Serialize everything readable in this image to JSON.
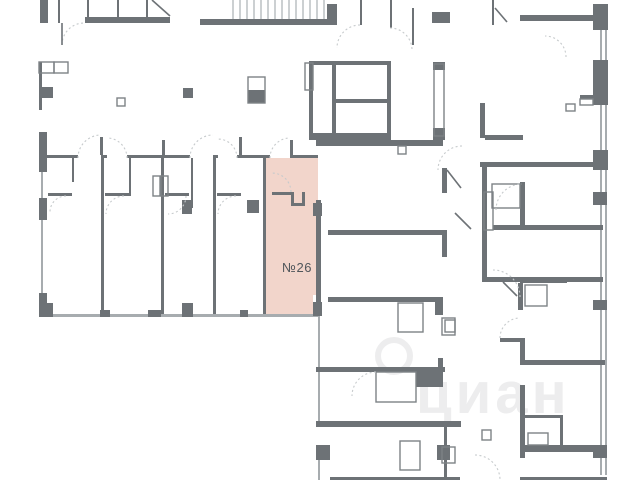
{
  "palette": {
    "background": "#ffffff",
    "wall": "#6d7276",
    "outline": "#7d8286",
    "window": "#a7acaf",
    "arc": "#c6cacc",
    "stair": "#9aa0a4",
    "highlight_fill": "#f2d5cb",
    "label_color": "#50565b",
    "watermark_color": "#ededee"
  },
  "unit": {
    "label": "№26",
    "x": 266,
    "y": 158,
    "w": 52,
    "h": 156,
    "label_x": 297,
    "label_y": 272,
    "notch": [
      313,
      295,
      8,
      20
    ]
  },
  "watermark": {
    "text": "циан",
    "x": 416,
    "y": 413,
    "size": 58,
    "circle": {
      "cx": 394,
      "cy": 356,
      "r": 16
    }
  },
  "stairs": {
    "x": 233,
    "y": 0,
    "w": 94,
    "h": 20,
    "step": 7
  },
  "geometry": {
    "walls": [
      [
        40,
        0,
        8,
        23
      ],
      [
        85,
        17,
        85,
        6
      ],
      [
        200,
        19,
        137,
        6
      ],
      [
        327,
        4,
        10,
        21
      ],
      [
        432,
        12,
        18,
        11
      ],
      [
        520,
        15,
        74,
        6
      ],
      [
        593,
        4,
        15,
        26
      ],
      [
        39,
        132,
        8,
        40
      ],
      [
        39,
        198,
        8,
        22
      ],
      [
        39,
        293,
        8,
        24
      ],
      [
        40,
        303,
        13,
        14
      ],
      [
        42,
        87,
        11,
        11
      ],
      [
        183,
        88,
        10,
        10
      ],
      [
        248,
        90,
        17,
        13
      ],
      [
        309,
        61,
        4,
        79
      ],
      [
        387,
        61,
        4,
        79
      ],
      [
        309,
        61,
        82,
        4
      ],
      [
        309,
        133,
        82,
        7
      ],
      [
        332,
        63,
        4,
        70
      ],
      [
        336,
        99,
        51,
        4
      ],
      [
        433,
        62,
        12,
        8
      ],
      [
        433,
        128,
        12,
        12
      ],
      [
        316,
        140,
        127,
        6
      ],
      [
        328,
        230,
        115,
        5
      ],
      [
        328,
        297,
        115,
        5
      ],
      [
        442,
        168,
        5,
        25
      ],
      [
        442,
        230,
        5,
        27
      ],
      [
        435,
        297,
        8,
        18
      ],
      [
        480,
        103,
        5,
        35
      ],
      [
        485,
        135,
        38,
        5
      ],
      [
        480,
        162,
        121,
        5
      ],
      [
        482,
        167,
        5,
        65
      ],
      [
        520,
        182,
        5,
        45
      ],
      [
        493,
        225,
        110,
        5
      ],
      [
        482,
        230,
        5,
        52
      ],
      [
        483,
        277,
        120,
        5
      ],
      [
        520,
        280,
        47,
        3
      ],
      [
        518,
        283,
        5,
        27
      ],
      [
        593,
        300,
        14,
        10
      ],
      [
        580,
        95,
        15,
        4
      ],
      [
        500,
        338,
        22,
        4
      ],
      [
        520,
        338,
        5,
        27
      ],
      [
        522,
        360,
        83,
        5
      ],
      [
        316,
        367,
        129,
        5
      ],
      [
        316,
        421,
        145,
        6
      ],
      [
        416,
        372,
        24,
        15
      ],
      [
        438,
        358,
        5,
        29
      ],
      [
        316,
        445,
        14,
        15
      ],
      [
        437,
        445,
        13,
        15
      ],
      [
        520,
        385,
        5,
        73
      ],
      [
        522,
        445,
        85,
        7
      ],
      [
        593,
        445,
        14,
        13
      ],
      [
        593,
        60,
        15,
        45
      ],
      [
        593,
        150,
        15,
        20
      ],
      [
        593,
        192,
        14,
        13
      ],
      [
        525,
        415,
        38,
        3
      ],
      [
        560,
        418,
        3,
        27
      ],
      [
        182,
        200,
        10,
        14
      ],
      [
        247,
        200,
        12,
        13
      ],
      [
        313,
        203,
        9,
        13
      ],
      [
        313,
        302,
        9,
        14
      ],
      [
        316,
        200,
        5,
        103
      ],
      [
        100,
        310,
        10,
        7
      ],
      [
        148,
        310,
        13,
        7
      ],
      [
        182,
        303,
        11,
        14
      ],
      [
        240,
        310,
        8,
        7
      ],
      [
        330,
        477,
        130,
        3
      ],
      [
        520,
        477,
        87,
        3
      ]
    ],
    "thin_walls": [
      [
        58,
        0,
        2,
        23
      ],
      [
        87,
        0,
        2,
        17
      ],
      [
        117,
        0,
        2,
        17
      ],
      [
        146,
        0,
        2,
        17
      ],
      [
        360,
        0,
        2,
        25
      ],
      [
        390,
        0,
        2,
        28
      ],
      [
        412,
        8,
        2,
        37
      ],
      [
        492,
        0,
        2,
        25
      ],
      [
        44,
        155,
        34,
        3
      ],
      [
        101,
        155,
        6,
        3
      ],
      [
        127,
        155,
        63,
        3
      ],
      [
        213,
        155,
        5,
        3
      ],
      [
        237,
        155,
        33,
        3
      ],
      [
        290,
        155,
        28,
        3
      ],
      [
        100,
        137,
        3,
        18
      ],
      [
        162,
        140,
        3,
        15
      ],
      [
        239,
        137,
        3,
        18
      ],
      [
        290,
        140,
        3,
        15
      ],
      [
        101,
        158,
        3,
        156
      ],
      [
        161,
        158,
        3,
        156
      ],
      [
        213,
        158,
        3,
        156
      ],
      [
        263,
        158,
        3,
        156
      ],
      [
        72,
        158,
        2,
        24
      ],
      [
        129,
        158,
        2,
        38
      ],
      [
        191,
        158,
        2,
        50
      ],
      [
        48,
        193,
        24,
        3
      ],
      [
        105,
        193,
        24,
        3
      ],
      [
        165,
        193,
        24,
        3
      ],
      [
        217,
        193,
        24,
        3
      ],
      [
        272,
        192,
        21,
        3
      ],
      [
        291,
        192,
        3,
        14
      ],
      [
        291,
        203,
        12,
        3
      ],
      [
        302,
        192,
        3,
        14
      ],
      [
        39,
        62,
        3,
        48
      ],
      [
        444,
        427,
        3,
        53
      ]
    ],
    "outlines": [
      [
        39,
        62,
        15,
        11
      ],
      [
        54,
        62,
        14,
        11
      ],
      [
        117,
        98,
        8,
        8
      ],
      [
        248,
        77,
        17,
        26
      ],
      [
        305,
        63,
        8,
        27
      ],
      [
        434,
        64,
        10,
        72
      ],
      [
        398,
        146,
        8,
        8
      ],
      [
        566,
        104,
        9,
        7
      ],
      [
        580,
        99,
        13,
        6
      ],
      [
        484,
        192,
        9,
        38
      ],
      [
        492,
        184,
        28,
        24
      ],
      [
        525,
        285,
        22,
        21
      ],
      [
        153,
        176,
        7,
        20
      ],
      [
        161,
        176,
        7,
        20
      ],
      [
        376,
        372,
        40,
        30
      ],
      [
        398,
        303,
        25,
        29
      ],
      [
        445,
        320,
        10,
        12
      ],
      [
        400,
        441,
        20,
        29
      ],
      [
        442,
        318,
        13,
        17
      ],
      [
        442,
        447,
        13,
        16
      ],
      [
        482,
        430,
        9,
        10
      ],
      [
        528,
        433,
        20,
        12
      ]
    ],
    "windows": [
      [
        41,
        172,
        2,
        26
      ],
      [
        41,
        220,
        2,
        73
      ],
      [
        44,
        314,
        274,
        3
      ],
      [
        600,
        5,
        2,
        470
      ],
      [
        605,
        5,
        2,
        470
      ],
      [
        318,
        316,
        2,
        51
      ],
      [
        318,
        372,
        2,
        49
      ],
      [
        318,
        460,
        2,
        20
      ]
    ],
    "arcs": [
      "M62,45 A22,22 0 0 1 84,23",
      "M78,158 A23,23 0 0 1 101,135",
      "M127,158 A20,20 0 0 0 107,138",
      "M190,158 A23,23 0 0 1 213,135",
      "M237,158 A19,19 0 0 0 218,139",
      "M270,158 A20,20 0 0 1 290,138",
      "M291,192 A19,19 0 0 0 272,173",
      "M66,196 A16,16 0 0 0 50,212",
      "M124,196 A18,18 0 0 0 106,214",
      "M186,196 A18,18 0 0 1 168,214",
      "M236,196 A18,18 0 0 0 218,214",
      "M360,25 A23,23 0 0 0 337,48",
      "M390,28 A22,22 0 0 1 412,50",
      "M566,57 A21,21 0 0 0 545,36",
      "M496,210 A26,26 0 0 1 522,184",
      "M520,297 A27,27 0 0 0 493,270",
      "M500,338 A20,20 0 0 1 520,318",
      "M376,372 A24,24 0 0 0 352,396",
      "M462,146 A24,24 0 0 0 438,170",
      "M475,455 A25,25 0 0 1 500,480"
    ],
    "lines": [
      [
        62,
        23,
        62,
        45
      ],
      [
        152,
        0,
        170,
        16
      ],
      [
        495,
        8,
        507,
        22
      ],
      [
        447,
        170,
        461,
        188
      ],
      [
        455,
        213,
        471,
        229
      ],
      [
        503,
        282,
        517,
        296
      ]
    ]
  }
}
